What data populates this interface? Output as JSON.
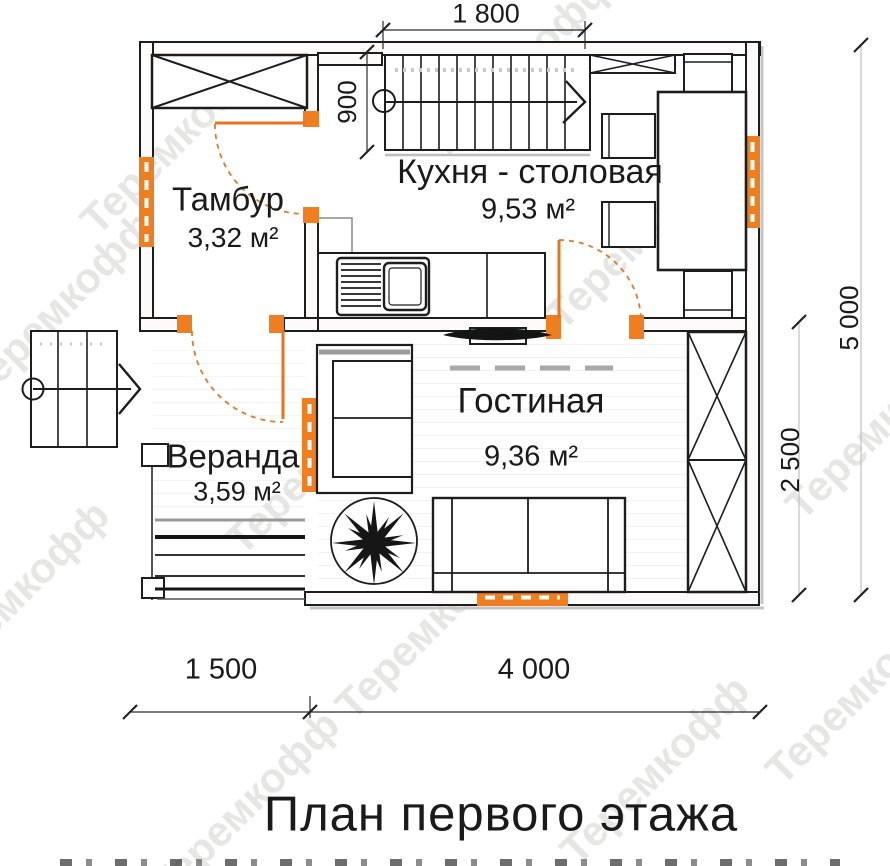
{
  "plan": {
    "title": "План первого этажа",
    "watermark": "Теремкофф",
    "rooms": [
      {
        "name": "Тамбур",
        "area": "3,32 м²"
      },
      {
        "name": "Кухня - столовая",
        "area": "9,53 м²"
      },
      {
        "name": "Гостиная",
        "area": "9,36 м²"
      },
      {
        "name": "Веранда",
        "area": "3,59 м²"
      }
    ],
    "dimensions": {
      "top_width": "1 800",
      "stair_landing": "900",
      "right_total": "5 000",
      "right_living": "2 500",
      "bottom_left": "1 500",
      "bottom_right": "4 000"
    },
    "colors": {
      "accent_orange": "#F07E1E",
      "line_black": "#1d1d1d",
      "watermark_gray": "#cfcecd"
    }
  }
}
